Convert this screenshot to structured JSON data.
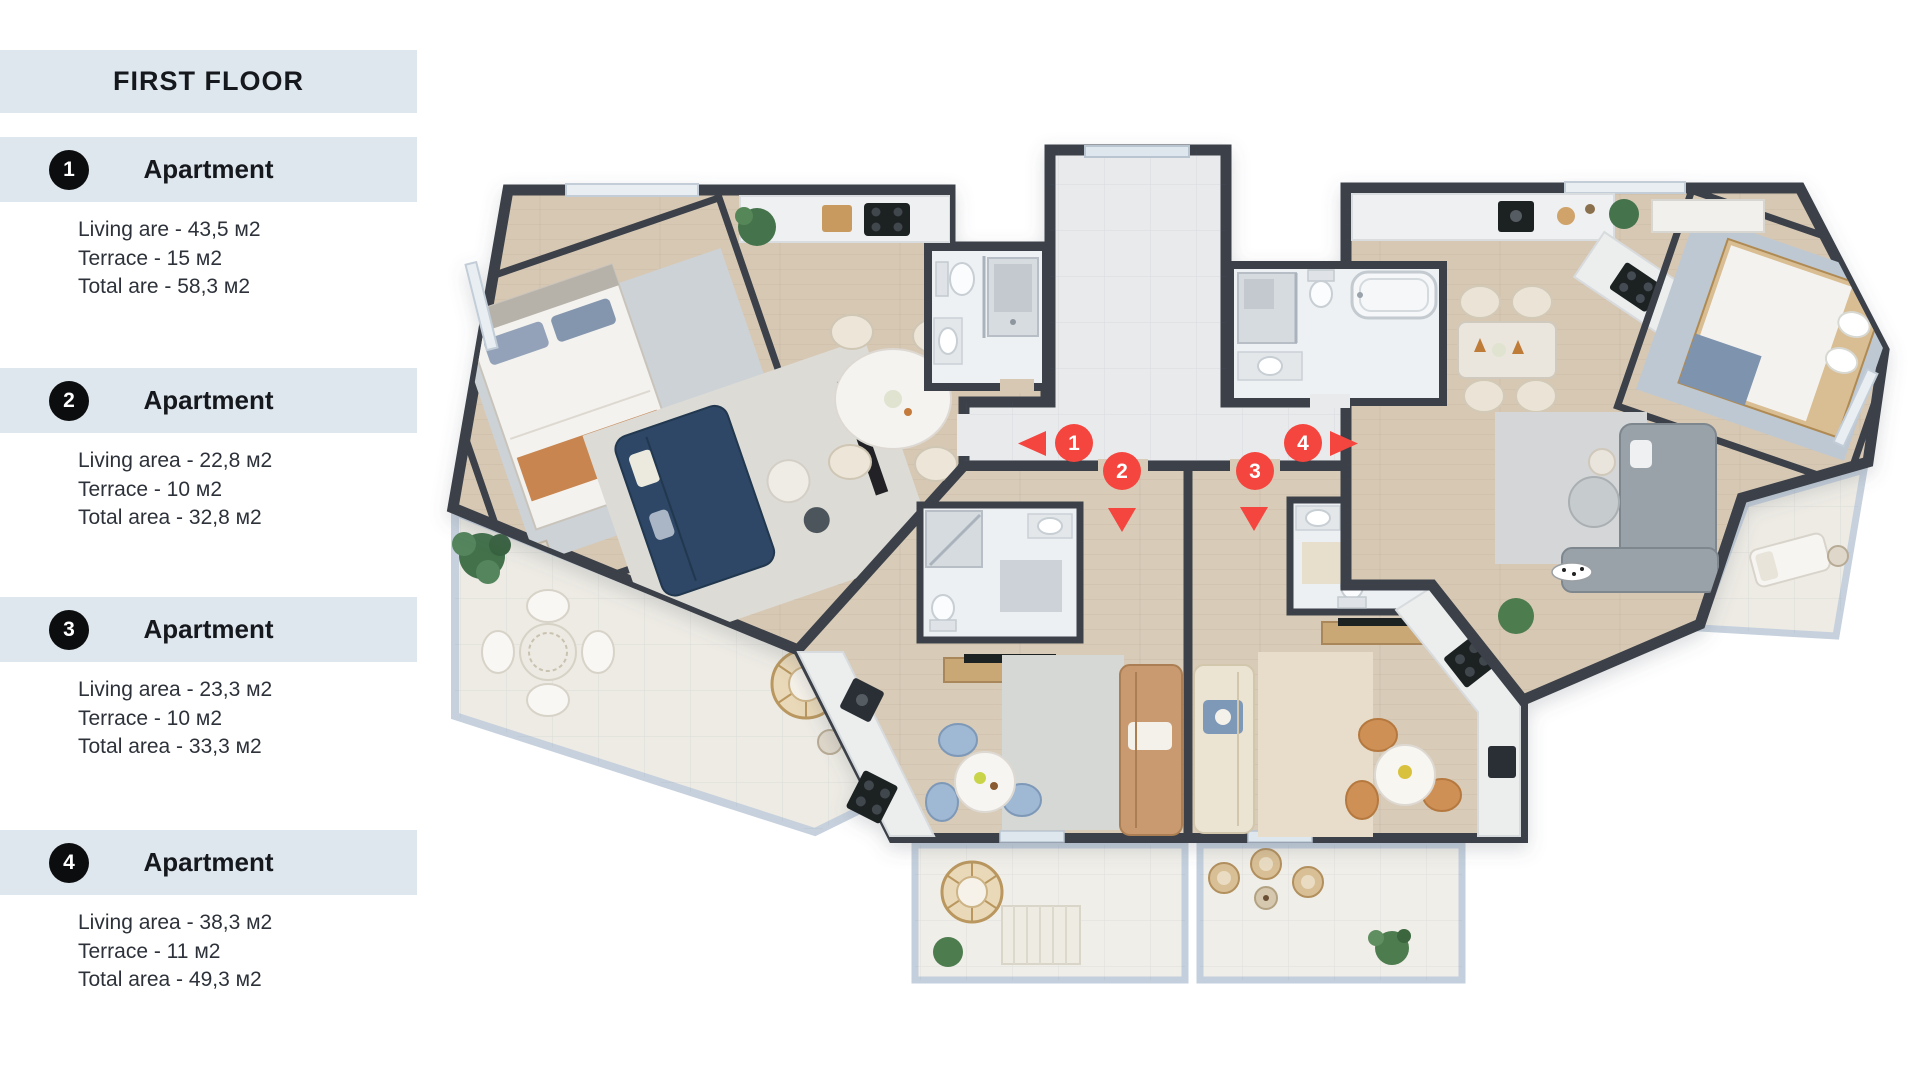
{
  "sidebar": {
    "title": "FIRST FLOOR",
    "apartments": [
      {
        "number": "1",
        "label": "Apartment",
        "details": [
          "Living are - 43,5 м2",
          "Terrace - 15 м2",
          "Total are - 58,3 м2"
        ]
      },
      {
        "number": "2",
        "label": "Apartment",
        "details": [
          "Living area - 22,8 м2",
          "Terrace - 10 м2",
          "Total area - 32,8 м2"
        ]
      },
      {
        "number": "3",
        "label": "Apartment",
        "details": [
          "Living area - 23,3 м2",
          "Terrace - 10 м2",
          "Total area - 33,3 м2"
        ]
      },
      {
        "number": "4",
        "label": "Apartment",
        "details": [
          "Living area - 38,3 м2",
          "Terrace - 11 м2",
          "Total area - 49,3 м2"
        ]
      }
    ],
    "colors": {
      "box_bg": "#dfe7ee",
      "badge_bg": "#0c0d0f",
      "badge_text": "#ffffff",
      "text": "#15181d"
    }
  },
  "floorplan": {
    "markers": [
      {
        "label": "1",
        "x": 1074,
        "y": 443,
        "arrow": "left"
      },
      {
        "label": "2",
        "x": 1122,
        "y": 471,
        "arrow": "down"
      },
      {
        "label": "3",
        "x": 1255,
        "y": 471,
        "arrow": "down"
      },
      {
        "label": "4",
        "x": 1303,
        "y": 443,
        "arrow": "right"
      }
    ],
    "colors": {
      "marker": "#f5453f",
      "wall": "#3b4149",
      "wood_floor": "#d7c8b4",
      "tile_floor": "#e9eaec",
      "terrace_floor": "#edebe4",
      "railing": "#c3cfdc"
    },
    "icons": {
      "marker_shape": "red-circle-pin",
      "arrow_shape": "red-triangle"
    }
  }
}
